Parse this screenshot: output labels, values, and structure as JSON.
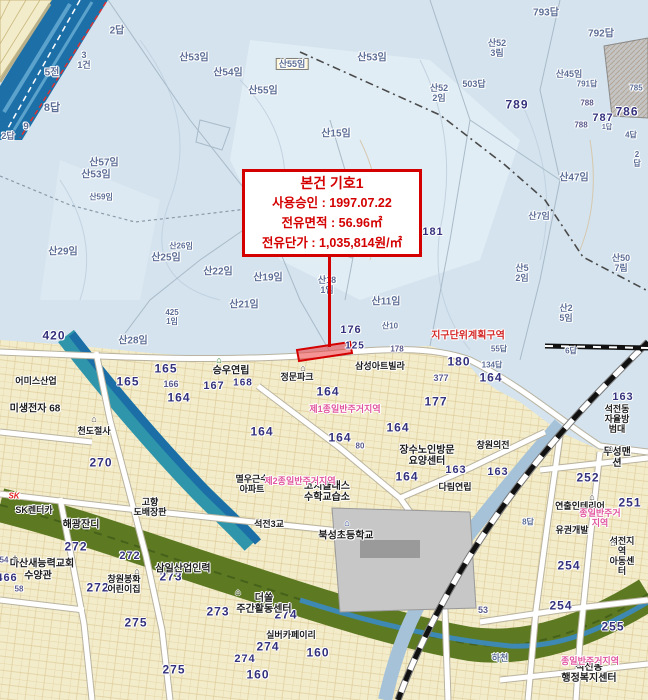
{
  "annotation": {
    "title": "본건 기호1",
    "line1": "사용승인 : 1997.07.22",
    "line2": "전유면적 : 56.96㎡",
    "line3": "전유단가 : 1,035,814원/㎡"
  },
  "highlight_parcel_number": "125",
  "colors": {
    "annotation_red": "#d40000",
    "zone_pink": "#e0559d",
    "highlight_fill": "#f08080",
    "mountain_blue": "#d4e3ee",
    "urban_cream": "#f3ecca",
    "river_teal": "#2f95aa",
    "river_deep_blue": "#1d6fa8",
    "green_corridor": "#5d7a23"
  },
  "map_labels": [
    {
      "t": "2답",
      "x": 117,
      "y": 31,
      "c": "mtn",
      "s": 10
    },
    {
      "t": "3\n1건",
      "x": 84,
      "y": 60,
      "c": "mtn",
      "s": 9
    },
    {
      "t": "5전",
      "x": 52,
      "y": 73,
      "c": "mtn",
      "s": 10
    },
    {
      "t": "8답",
      "x": 52,
      "y": 108,
      "c": "mtn",
      "s": 11
    },
    {
      "t": "9",
      "x": 26,
      "y": 127,
      "c": "mtn",
      "s": 10
    },
    {
      "t": "2답",
      "x": 8,
      "y": 136,
      "c": "mtn",
      "s": 9
    },
    {
      "t": "산53임",
      "x": 194,
      "y": 58,
      "c": "mtn",
      "s": 10
    },
    {
      "t": "산54임",
      "x": 228,
      "y": 73,
      "c": "mtn",
      "s": 10
    },
    {
      "t": "산55임",
      "x": 292,
      "y": 64,
      "c": "boxed",
      "s": 9
    },
    {
      "t": "산55임",
      "x": 263,
      "y": 91,
      "c": "mtn",
      "s": 10
    },
    {
      "t": "산15임",
      "x": 336,
      "y": 134,
      "c": "mtn",
      "s": 10
    },
    {
      "t": "산57임",
      "x": 104,
      "y": 163,
      "c": "mtn",
      "s": 10
    },
    {
      "t": "산53임",
      "x": 96,
      "y": 175,
      "c": "mtn",
      "s": 10
    },
    {
      "t": "산59임",
      "x": 101,
      "y": 198,
      "c": "mtn",
      "s": 8
    },
    {
      "t": "산29임",
      "x": 63,
      "y": 252,
      "c": "mtn",
      "s": 10
    },
    {
      "t": "산26임",
      "x": 181,
      "y": 247,
      "c": "mtn",
      "s": 8
    },
    {
      "t": "산25임",
      "x": 166,
      "y": 258,
      "c": "mtn",
      "s": 10
    },
    {
      "t": "산22임",
      "x": 218,
      "y": 272,
      "c": "mtn",
      "s": 10
    },
    {
      "t": "산28임",
      "x": 133,
      "y": 341,
      "c": "mtn",
      "s": 10
    },
    {
      "t": "425\n1임",
      "x": 172,
      "y": 318,
      "c": "mtn",
      "s": 8
    },
    {
      "t": "산19임",
      "x": 268,
      "y": 278,
      "c": "mtn",
      "s": 10
    },
    {
      "t": "산21임",
      "x": 244,
      "y": 305,
      "c": "mtn",
      "s": 10
    },
    {
      "t": "산18\n1임",
      "x": 327,
      "y": 285,
      "c": "mtn",
      "s": 9
    },
    {
      "t": "산11임",
      "x": 386,
      "y": 302,
      "c": "mtn",
      "s": 10
    },
    {
      "t": "산10",
      "x": 390,
      "y": 327,
      "c": "mtn",
      "s": 8
    },
    {
      "t": "산53임",
      "x": 372,
      "y": 58,
      "c": "mtn",
      "s": 10
    },
    {
      "t": "산52\n3림",
      "x": 497,
      "y": 48,
      "c": "mtn",
      "s": 9
    },
    {
      "t": "산52\n2임",
      "x": 439,
      "y": 93,
      "c": "mtn",
      "s": 9
    },
    {
      "t": "503답",
      "x": 474,
      "y": 84,
      "c": "mtn",
      "s": 9
    },
    {
      "t": "793답",
      "x": 546,
      "y": 13,
      "c": "mtn",
      "s": 10
    },
    {
      "t": "792답",
      "x": 601,
      "y": 34,
      "c": "mtn",
      "s": 10
    },
    {
      "t": "산45임",
      "x": 569,
      "y": 74,
      "c": "mtn",
      "s": 9
    },
    {
      "t": "791답",
      "x": 587,
      "y": 85,
      "c": "mtn",
      "s": 8
    },
    {
      "t": "785",
      "x": 636,
      "y": 89,
      "c": "mtn",
      "s": 8
    },
    {
      "t": "788",
      "x": 587,
      "y": 104,
      "c": "numSmall",
      "s": 8
    },
    {
      "t": "788",
      "x": 581,
      "y": 126,
      "c": "numSmall",
      "s": 8
    },
    {
      "t": "787",
      "x": 603,
      "y": 118,
      "c": "num",
      "s": 11
    },
    {
      "t": "786",
      "x": 627,
      "y": 112,
      "c": "num",
      "s": 12
    },
    {
      "t": "789",
      "x": 517,
      "y": 105,
      "c": "num",
      "s": 12
    },
    {
      "t": "1답",
      "x": 607,
      "y": 128,
      "c": "mtn",
      "s": 7
    },
    {
      "t": "4답",
      "x": 631,
      "y": 136,
      "c": "mtn",
      "s": 8
    },
    {
      "t": "2답",
      "x": 637,
      "y": 160,
      "c": "mtn",
      "s": 8
    },
    {
      "t": "산47임",
      "x": 574,
      "y": 178,
      "c": "mtn",
      "s": 10
    },
    {
      "t": "산7임",
      "x": 539,
      "y": 216,
      "c": "mtn",
      "s": 9
    },
    {
      "t": "181",
      "x": 433,
      "y": 232,
      "c": "num",
      "s": 11
    },
    {
      "t": "산50\n7림",
      "x": 621,
      "y": 263,
      "c": "mtn",
      "s": 9
    },
    {
      "t": "산5\n2임",
      "x": 522,
      "y": 273,
      "c": "mtn",
      "s": 9
    },
    {
      "t": "산2\n5임",
      "x": 566,
      "y": 313,
      "c": "mtn",
      "s": 9
    },
    {
      "t": "6답",
      "x": 571,
      "y": 352,
      "c": "mtn",
      "s": 8
    },
    {
      "t": "55답",
      "x": 499,
      "y": 350,
      "c": "mtn",
      "s": 8
    },
    {
      "t": "134답",
      "x": 492,
      "y": 366,
      "c": "mtn",
      "s": 8
    },
    {
      "t": "8답",
      "x": 528,
      "y": 523,
      "c": "mtn",
      "s": 8
    },
    {
      "t": "하천",
      "x": 500,
      "y": 658,
      "c": "mtn",
      "s": 9
    },
    {
      "t": "지구단위계획구역",
      "x": 468,
      "y": 336,
      "c": "red",
      "s": 10
    },
    {
      "t": "176",
      "x": 351,
      "y": 330,
      "c": "num",
      "s": 11
    },
    {
      "t": "125",
      "x": 355,
      "y": 346,
      "c": "num",
      "s": 10
    },
    {
      "t": "178",
      "x": 397,
      "y": 350,
      "c": "numSmall",
      "s": 8
    },
    {
      "t": "420",
      "x": 54,
      "y": 336,
      "c": "num",
      "s": 12
    },
    {
      "t": "165",
      "x": 166,
      "y": 369,
      "c": "num",
      "s": 12
    },
    {
      "t": "165",
      "x": 128,
      "y": 382,
      "c": "num",
      "s": 12
    },
    {
      "t": "166",
      "x": 171,
      "y": 384,
      "c": "numSmall",
      "s": 9
    },
    {
      "t": "164",
      "x": 179,
      "y": 398,
      "c": "num",
      "s": 12
    },
    {
      "t": "167",
      "x": 214,
      "y": 386,
      "c": "num",
      "s": 11
    },
    {
      "t": "168",
      "x": 243,
      "y": 383,
      "c": "num",
      "s": 10
    },
    {
      "t": "270",
      "x": 101,
      "y": 463,
      "c": "num",
      "s": 12
    },
    {
      "t": "164",
      "x": 262,
      "y": 432,
      "c": "num",
      "s": 12
    },
    {
      "t": "164",
      "x": 328,
      "y": 392,
      "c": "num",
      "s": 12
    },
    {
      "t": "164",
      "x": 340,
      "y": 438,
      "c": "num",
      "s": 12
    },
    {
      "t": "164",
      "x": 398,
      "y": 428,
      "c": "num",
      "s": 12
    },
    {
      "t": "164",
      "x": 407,
      "y": 477,
      "c": "num",
      "s": 12
    },
    {
      "t": "177",
      "x": 436,
      "y": 402,
      "c": "num",
      "s": 12
    },
    {
      "t": "180",
      "x": 459,
      "y": 362,
      "c": "num",
      "s": 12
    },
    {
      "t": "377",
      "x": 441,
      "y": 378,
      "c": "numSmall",
      "s": 9
    },
    {
      "t": "164",
      "x": 491,
      "y": 378,
      "c": "num",
      "s": 12
    },
    {
      "t": "80",
      "x": 360,
      "y": 447,
      "c": "numSmall",
      "s": 8
    },
    {
      "t": "272",
      "x": 76,
      "y": 547,
      "c": "num",
      "s": 12
    },
    {
      "t": "272",
      "x": 130,
      "y": 556,
      "c": "num",
      "s": 11
    },
    {
      "t": "272",
      "x": 98,
      "y": 588,
      "c": "num",
      "s": 12
    },
    {
      "t": "466",
      "x": 7,
      "y": 578,
      "c": "num",
      "s": 11
    },
    {
      "t": "54",
      "x": 4,
      "y": 561,
      "c": "numSmall",
      "s": 8
    },
    {
      "t": "58",
      "x": 19,
      "y": 590,
      "c": "numSmall",
      "s": 8
    },
    {
      "t": "273",
      "x": 171,
      "y": 577,
      "c": "num",
      "s": 12
    },
    {
      "t": "273",
      "x": 218,
      "y": 612,
      "c": "num",
      "s": 12
    },
    {
      "t": "274",
      "x": 286,
      "y": 615,
      "c": "num",
      "s": 12
    },
    {
      "t": "274",
      "x": 268,
      "y": 647,
      "c": "num",
      "s": 12
    },
    {
      "t": "274",
      "x": 245,
      "y": 659,
      "c": "num",
      "s": 11
    },
    {
      "t": "275",
      "x": 136,
      "y": 623,
      "c": "num",
      "s": 12
    },
    {
      "t": "275",
      "x": 174,
      "y": 670,
      "c": "num",
      "s": 12
    },
    {
      "t": "160",
      "x": 318,
      "y": 653,
      "c": "num",
      "s": 12
    },
    {
      "t": "160",
      "x": 258,
      "y": 675,
      "c": "num",
      "s": 12
    },
    {
      "t": "252",
      "x": 588,
      "y": 478,
      "c": "num",
      "s": 12
    },
    {
      "t": "251",
      "x": 630,
      "y": 503,
      "c": "num",
      "s": 12
    },
    {
      "t": "254",
      "x": 569,
      "y": 566,
      "c": "num",
      "s": 12
    },
    {
      "t": "254",
      "x": 561,
      "y": 606,
      "c": "num",
      "s": 12
    },
    {
      "t": "255",
      "x": 613,
      "y": 627,
      "c": "num",
      "s": 12
    },
    {
      "t": "163",
      "x": 456,
      "y": 470,
      "c": "num",
      "s": 11
    },
    {
      "t": "163",
      "x": 498,
      "y": 472,
      "c": "num",
      "s": 11
    },
    {
      "t": "163",
      "x": 623,
      "y": 397,
      "c": "num",
      "s": 11
    },
    {
      "t": "53",
      "x": 483,
      "y": 610,
      "c": "numSmall",
      "s": 9
    },
    {
      "t": "승우연립",
      "x": 231,
      "y": 371,
      "c": "fac",
      "s": 10
    },
    {
      "t": "정문파크",
      "x": 297,
      "y": 377,
      "c": "fac",
      "s": 9
    },
    {
      "t": "삼성아트빌라",
      "x": 380,
      "y": 366,
      "c": "fac",
      "s": 9
    },
    {
      "t": "장수노인방문\n요양센터",
      "x": 427,
      "y": 456,
      "c": "fac",
      "s": 10
    },
    {
      "t": "창원의전",
      "x": 493,
      "y": 445,
      "c": "fac",
      "s": 9
    },
    {
      "t": "다림연립",
      "x": 455,
      "y": 487,
      "c": "fac",
      "s": 9
    },
    {
      "t": "무성맨션",
      "x": 617,
      "y": 458,
      "c": "fac",
      "s": 10
    },
    {
      "t": "연출인테리어",
      "x": 580,
      "y": 506,
      "c": "fac",
      "s": 9
    },
    {
      "t": "유권개발",
      "x": 572,
      "y": 530,
      "c": "fac",
      "s": 9
    },
    {
      "t": "석전지역\n아동센터",
      "x": 622,
      "y": 556,
      "c": "fac",
      "s": 9
    },
    {
      "t": "석전동\n행정복지센터",
      "x": 589,
      "y": 673,
      "c": "fac",
      "s": 10
    },
    {
      "t": "북성초등학교",
      "x": 346,
      "y": 536,
      "c": "fac",
      "s": 10
    },
    {
      "t": "석전3교",
      "x": 269,
      "y": 524,
      "c": "fac",
      "s": 9
    },
    {
      "t": "멸우근수\n아파트",
      "x": 252,
      "y": 484,
      "c": "fac",
      "s": 9
    },
    {
      "t": "코치클래스\n수학교습소",
      "x": 327,
      "y": 492,
      "c": "fac",
      "s": 10
    },
    {
      "t": "더쏠\n주간활동센터",
      "x": 264,
      "y": 604,
      "c": "fac",
      "s": 10
    },
    {
      "t": "실버카페이리",
      "x": 291,
      "y": 635,
      "c": "fac",
      "s": 9
    },
    {
      "t": "창원봉화\n어린이집",
      "x": 124,
      "y": 584,
      "c": "fac",
      "s": 9
    },
    {
      "t": "마산새능력교회",
      "x": 42,
      "y": 564,
      "c": "fac",
      "s": 10
    },
    {
      "t": "수양관",
      "x": 38,
      "y": 576,
      "c": "fac",
      "s": 10
    },
    {
      "t": "해광잔디",
      "x": 81,
      "y": 525,
      "c": "fac",
      "s": 10
    },
    {
      "t": "SK렌터카",
      "x": 34,
      "y": 510,
      "c": "fac",
      "s": 9
    },
    {
      "t": "SK",
      "x": 14,
      "y": 497,
      "c": "sk",
      "s": 8
    },
    {
      "t": "고향\n도배장판",
      "x": 150,
      "y": 507,
      "c": "fac",
      "s": 9
    },
    {
      "t": "삼일산업인력",
      "x": 183,
      "y": 569,
      "c": "fac",
      "s": 10
    },
    {
      "t": "어미스산업",
      "x": 36,
      "y": 381,
      "c": "fac",
      "s": 9
    },
    {
      "t": "미생전자 68",
      "x": 35,
      "y": 409,
      "c": "fac",
      "s": 10
    },
    {
      "t": "천도절사",
      "x": 94,
      "y": 431,
      "c": "fac",
      "s": 9
    },
    {
      "t": "석전동\n자율방범대",
      "x": 617,
      "y": 419,
      "c": "fac",
      "s": 9
    },
    {
      "t": "제1종일반주거지역",
      "x": 345,
      "y": 409,
      "c": "zone",
      "s": 9
    },
    {
      "t": "제2종일반주거지역",
      "x": 300,
      "y": 481,
      "c": "zone",
      "s": 9
    },
    {
      "t": "종일반주거지역",
      "x": 600,
      "y": 518,
      "c": "zone",
      "s": 9
    },
    {
      "t": "종일반주거지역",
      "x": 590,
      "y": 661,
      "c": "zone",
      "s": 9
    }
  ],
  "icons": [
    {
      "name": "building-icon",
      "g": "⌂",
      "x": 219,
      "y": 360,
      "col": "#1d7a2a"
    },
    {
      "name": "building-icon",
      "g": "⌂",
      "x": 303,
      "y": 368,
      "col": "#444"
    },
    {
      "name": "building-icon",
      "g": "⌂",
      "x": 611,
      "y": 448,
      "col": "#444"
    },
    {
      "name": "building-icon",
      "g": "⌂",
      "x": 592,
      "y": 497,
      "col": "#444"
    },
    {
      "name": "building-icon",
      "g": "⌂",
      "x": 238,
      "y": 592,
      "col": "#444"
    },
    {
      "name": "building-icon",
      "g": "⌂",
      "x": 94,
      "y": 419,
      "col": "#444"
    },
    {
      "name": "building-icon",
      "g": "⌂",
      "x": 137,
      "y": 571,
      "col": "#444"
    },
    {
      "name": "building-icon",
      "g": "⌂",
      "x": 613,
      "y": 543,
      "col": "#444"
    },
    {
      "name": "school-icon",
      "g": "⌂",
      "x": 347,
      "y": 523,
      "col": "#2a4a9a"
    },
    {
      "name": "church-icon",
      "g": "†",
      "x": 15,
      "y": 559,
      "col": "#333"
    }
  ]
}
